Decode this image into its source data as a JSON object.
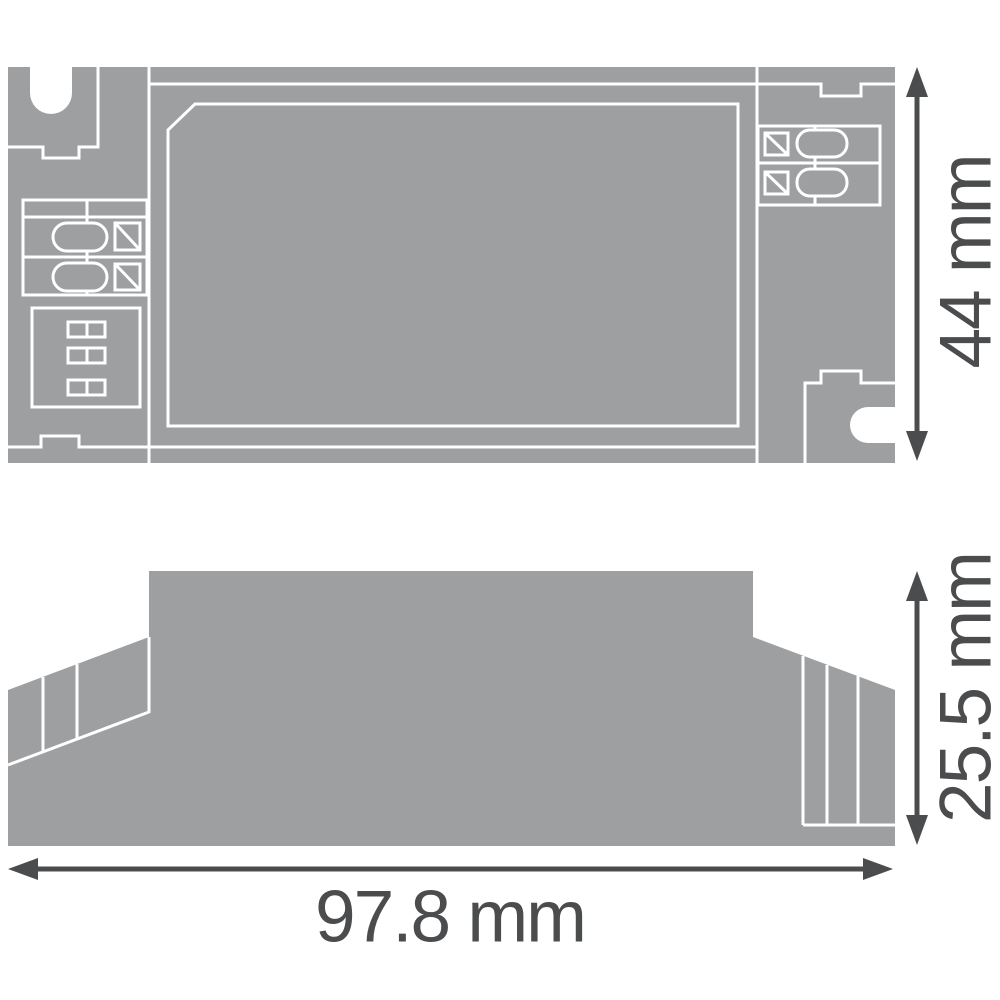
{
  "drawing": {
    "description": "Technical dimension drawing of an LED driver housing: top view and side profile view",
    "labels": {
      "height": "44 mm",
      "depth": "25.5 mm",
      "width": "97.8 mm"
    },
    "colors": {
      "body": "#9e9fa0",
      "line": "#ffffff",
      "dim": "#4b4c4e",
      "bg": "#ffffff"
    }
  }
}
